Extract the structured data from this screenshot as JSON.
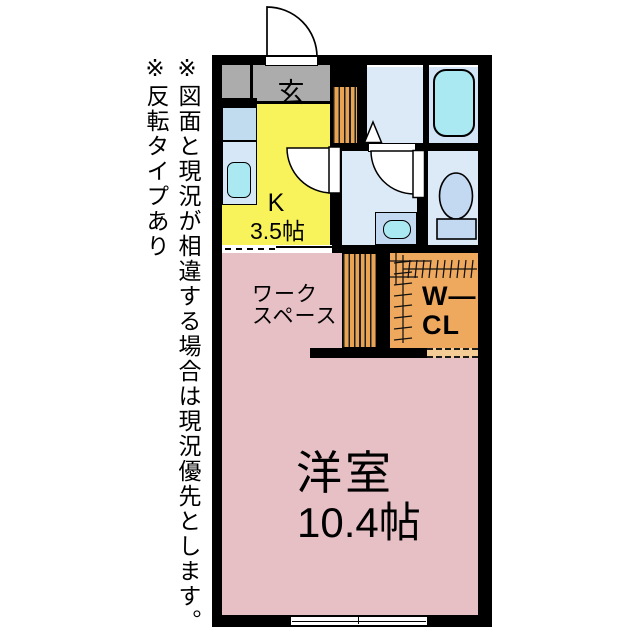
{
  "floorplan": {
    "notes": {
      "disclaimer": "※図面と現況が相違する場合は現況優先とします。",
      "reverse_type": "※反転タイプあり"
    },
    "rooms": {
      "entrance": {
        "label": "玄"
      },
      "kitchen": {
        "label": "K",
        "size": "3.5帖"
      },
      "workspace": {
        "label_line1": "ワーク",
        "label_line2": "スペース"
      },
      "walk_in_closet": {
        "label_line1": "W—",
        "label_line2": "CL"
      },
      "western_room": {
        "label": "洋室",
        "size": "10.4帖"
      }
    },
    "colors": {
      "wall": "#000000",
      "entrance_gray": "#acacac",
      "kitchen_yellow": "#f8f35b",
      "room_pink": "#e6c0c5",
      "wet_area_blue": "#dceaf8",
      "bath_blue": "#d2e4f5",
      "fixture_blue": "#c3d8f1",
      "water_cyan": "#abe9f2",
      "wood_orange": "#e8a353",
      "closet_orange": "#efa95e"
    }
  }
}
